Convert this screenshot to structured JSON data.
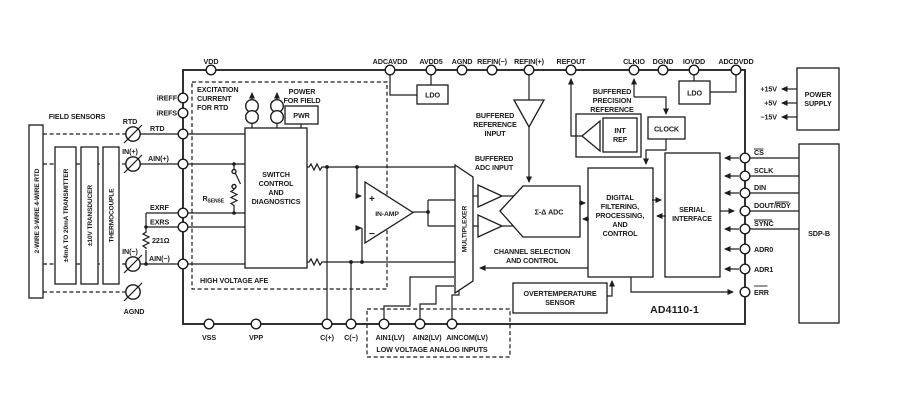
{
  "chip": {
    "part_number": "AD4110-1"
  },
  "field": {
    "label": "FIELD SENSORS",
    "boxes": [
      "2-WIRE 3-WIRE 4-WIRE RTD",
      "±4mA TO 20mA TRANSMITTER",
      "±10V TRANSDUCER",
      "THERMOCOUPLE"
    ],
    "terminals": {
      "rtd": "RTD",
      "in_p": "IN(+)",
      "in_n": "IN(−)",
      "agnd": "AGND"
    }
  },
  "left_pins": {
    "ireff": "iREFF",
    "irefs": "iREFS",
    "rtd": "RTD",
    "ain_p": "AIN(+)",
    "exrf": "EXRF",
    "exrs": "EXRS",
    "ain_n": "AIN(−)",
    "resistor": "221Ω"
  },
  "top_pins": [
    "VDD",
    "ADCAVDD",
    "AVDD5",
    "AGND",
    "REFIN(−)",
    "REFIN(+)",
    "REFOUT",
    "CLKIO",
    "DGND",
    "IOVDD",
    "ADCDVDD"
  ],
  "bottom_pins": [
    "VSS",
    "VPP",
    "C(+)",
    "C(−)",
    "AIN1(LV)",
    "AIN2(LV)",
    "AINCOM(LV)"
  ],
  "right_pins": {
    "cs": "CS",
    "sclk": "SCLK",
    "din": "DIN",
    "dout": "DOUT/",
    "rdy": "RDY",
    "sync": "SYNC",
    "adr0": "ADR0",
    "adr1": "ADR1",
    "err": "ERR"
  },
  "blocks": {
    "excitation": [
      "EXCITATION",
      "CURRENT",
      "FOR RTD"
    ],
    "power_field": [
      "POWER",
      "FOR FIELD"
    ],
    "pwr": "PWR",
    "switch": [
      "SWITCH",
      "CONTROL",
      "AND",
      "DIAGNOSTICS"
    ],
    "rsense": {
      "r": "R",
      "sub": "SENSE"
    },
    "hv_afe": "HIGH VOLTAGE AFE",
    "inamp": {
      "label": "IN-AMP",
      "plus": "+",
      "minus": "−"
    },
    "mux": "MULTIPLEXER",
    "buf_adc": [
      "BUFFERED",
      "ADC INPUT"
    ],
    "buf_ref": [
      "BUFFERED",
      "REFERENCE",
      "INPUT"
    ],
    "adc": "Σ-Δ ADC",
    "chan": [
      "CHANNEL SELECTION",
      "AND CONTROL"
    ],
    "ldo": "LDO",
    "buf_prec": [
      "BUFFERED",
      "PRECISION",
      "REFERENCE"
    ],
    "intref": [
      "INT",
      "REF"
    ],
    "clock": "CLOCK",
    "digital": [
      "DIGITAL",
      "FILTERING,",
      "PROCESSING,",
      "AND",
      "CONTROL"
    ],
    "serial": [
      "SERIAL",
      "INTERFACE"
    ],
    "overtemp": [
      "OVERTEMPERATURE",
      "SENSOR"
    ],
    "lv_inputs": "LOW VOLTAGE ANALOG INPUTS"
  },
  "right_side": {
    "power_supply": [
      "POWER",
      "SUPPLY"
    ],
    "rails": [
      "+15V",
      "+5V",
      "−15V"
    ],
    "sdp": "SDP-B"
  },
  "colors": {
    "ink": "#1b1b1b",
    "background": "#ffffff"
  }
}
